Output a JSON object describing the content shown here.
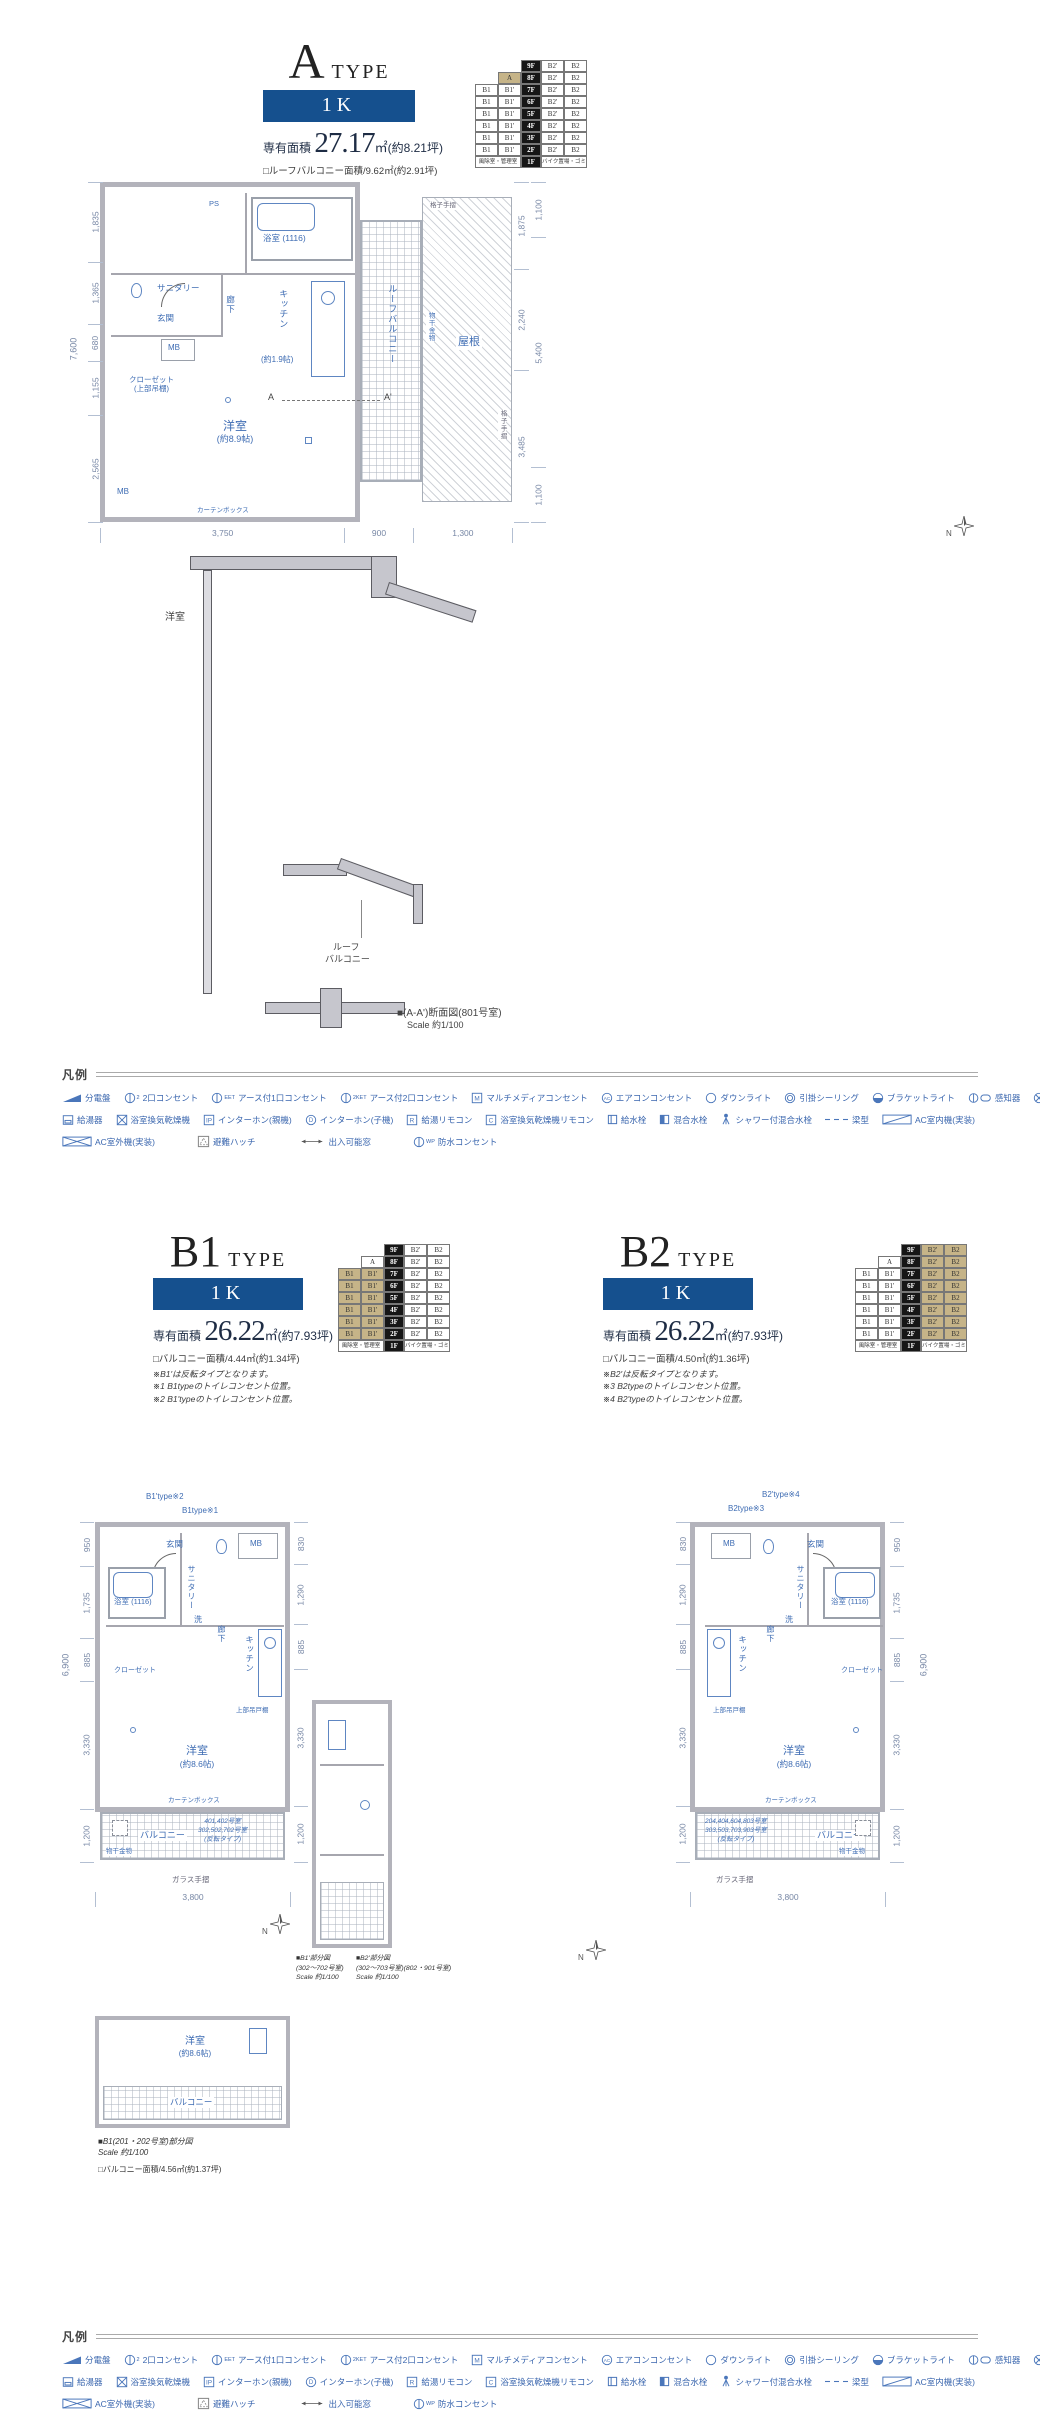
{
  "type_a": {
    "title": "A",
    "title_suffix": "TYPE",
    "plan_label": "1K",
    "area_label": "専有面積",
    "area_value": "27.17",
    "area_unit": "㎡",
    "area_tsubo": "(約8.21坪)",
    "balcony_note": "□ルーフバルコニー面積/9.62㎡(約2.91坪)",
    "dims": {
      "left_total": "7,600",
      "left": [
        "1,835",
        "1,365",
        "680",
        "1,155",
        "2,565"
      ],
      "right_inner": [
        "1,875",
        "2,240",
        "3,485"
      ],
      "right_outer": [
        "1,100",
        "5,400",
        "1,100"
      ],
      "bottom": [
        "3,750",
        "900",
        "1,300"
      ]
    },
    "rooms": {
      "bath": "浴室",
      "bath_size": "(1116)",
      "sanitary": "サニタリー",
      "ps": "PS",
      "entrance": "玄関",
      "hall": "廊下",
      "kitchen": "キッチン",
      "kitchen_size": "(約1.9帖)",
      "mb": "MB",
      "closet": "クローゼット",
      "closet_note": "(上部吊棚)",
      "western": "洋室",
      "western_size": "(約8.9帖)",
      "roof_balcony": "ルーフバルコニー",
      "roof": "屋根",
      "monohoshi": "物干金物",
      "koshi": "格子手摺",
      "curtain_box": "カーテンボックス",
      "marker_a": "A",
      "marker_a2": "A'"
    },
    "section": {
      "room": "洋室",
      "balcony_l1": "ルーフ",
      "balcony_l2": "バルコニー",
      "caption": "■(A-A')断面図(801号室)",
      "scale": "Scale 約1/100"
    }
  },
  "stack_a": {
    "rows": [
      {
        "skip": 2,
        "cells": [
          {
            "t": "9F",
            "s": "f"
          },
          {
            "t": "B2'",
            "s": "p"
          },
          {
            "t": "B2",
            "s": "p"
          }
        ]
      },
      {
        "skip": 1,
        "cells": [
          {
            "t": "A",
            "s": "h"
          },
          {
            "t": "8F",
            "s": "f"
          },
          {
            "t": "B2'",
            "s": "p"
          },
          {
            "t": "B2",
            "s": "p"
          }
        ]
      },
      {
        "skip": 0,
        "cells": [
          {
            "t": "B1",
            "s": "p"
          },
          {
            "t": "B1'",
            "s": "p"
          },
          {
            "t": "7F",
            "s": "f"
          },
          {
            "t": "B2'",
            "s": "p"
          },
          {
            "t": "B2",
            "s": "p"
          }
        ]
      },
      {
        "skip": 0,
        "cells": [
          {
            "t": "B1",
            "s": "p"
          },
          {
            "t": "B1'",
            "s": "p"
          },
          {
            "t": "6F",
            "s": "f"
          },
          {
            "t": "B2'",
            "s": "p"
          },
          {
            "t": "B2",
            "s": "p"
          }
        ]
      },
      {
        "skip": 0,
        "cells": [
          {
            "t": "B1",
            "s": "p"
          },
          {
            "t": "B1'",
            "s": "p"
          },
          {
            "t": "5F",
            "s": "f"
          },
          {
            "t": "B2'",
            "s": "p"
          },
          {
            "t": "B2",
            "s": "p"
          }
        ]
      },
      {
        "skip": 0,
        "cells": [
          {
            "t": "B1",
            "s": "p"
          },
          {
            "t": "B1'",
            "s": "p"
          },
          {
            "t": "4F",
            "s": "f"
          },
          {
            "t": "B2'",
            "s": "p"
          },
          {
            "t": "B2",
            "s": "p"
          }
        ]
      },
      {
        "skip": 0,
        "cells": [
          {
            "t": "B1",
            "s": "p"
          },
          {
            "t": "B1'",
            "s": "p"
          },
          {
            "t": "3F",
            "s": "f"
          },
          {
            "t": "B2'",
            "s": "p"
          },
          {
            "t": "B2",
            "s": "p"
          }
        ]
      },
      {
        "skip": 0,
        "cells": [
          {
            "t": "B1",
            "s": "p"
          },
          {
            "t": "B1'",
            "s": "p"
          },
          {
            "t": "2F",
            "s": "f"
          },
          {
            "t": "B2'",
            "s": "p"
          },
          {
            "t": "B2",
            "s": "p"
          }
        ]
      },
      {
        "skip": 0,
        "cells": [
          {
            "t": "風除室・管理室",
            "s": "w"
          },
          {
            "t": "1F",
            "s": "f"
          },
          {
            "t": "バイク置場・ゴミ置場",
            "s": "w"
          }
        ]
      }
    ]
  },
  "stack_b1": {
    "rows": [
      {
        "skip": 2,
        "cells": [
          {
            "t": "9F",
            "s": "f"
          },
          {
            "t": "B2'",
            "s": "p"
          },
          {
            "t": "B2",
            "s": "p"
          }
        ]
      },
      {
        "skip": 1,
        "cells": [
          {
            "t": "A",
            "s": "p"
          },
          {
            "t": "8F",
            "s": "f"
          },
          {
            "t": "B2'",
            "s": "p"
          },
          {
            "t": "B2",
            "s": "p"
          }
        ]
      },
      {
        "skip": 0,
        "cells": [
          {
            "t": "B1",
            "s": "h"
          },
          {
            "t": "B1'",
            "s": "h"
          },
          {
            "t": "7F",
            "s": "f"
          },
          {
            "t": "B2'",
            "s": "p"
          },
          {
            "t": "B2",
            "s": "p"
          }
        ]
      },
      {
        "skip": 0,
        "cells": [
          {
            "t": "B1",
            "s": "h"
          },
          {
            "t": "B1'",
            "s": "h"
          },
          {
            "t": "6F",
            "s": "f"
          },
          {
            "t": "B2'",
            "s": "p"
          },
          {
            "t": "B2",
            "s": "p"
          }
        ]
      },
      {
        "skip": 0,
        "cells": [
          {
            "t": "B1",
            "s": "h"
          },
          {
            "t": "B1'",
            "s": "h"
          },
          {
            "t": "5F",
            "s": "f"
          },
          {
            "t": "B2'",
            "s": "p"
          },
          {
            "t": "B2",
            "s": "p"
          }
        ]
      },
      {
        "skip": 0,
        "cells": [
          {
            "t": "B1",
            "s": "h"
          },
          {
            "t": "B1'",
            "s": "h"
          },
          {
            "t": "4F",
            "s": "f"
          },
          {
            "t": "B2'",
            "s": "p"
          },
          {
            "t": "B2",
            "s": "p"
          }
        ]
      },
      {
        "skip": 0,
        "cells": [
          {
            "t": "B1",
            "s": "h"
          },
          {
            "t": "B1'",
            "s": "h"
          },
          {
            "t": "3F",
            "s": "f"
          },
          {
            "t": "B2'",
            "s": "p"
          },
          {
            "t": "B2",
            "s": "p"
          }
        ]
      },
      {
        "skip": 0,
        "cells": [
          {
            "t": "B1",
            "s": "h"
          },
          {
            "t": "B1'",
            "s": "h"
          },
          {
            "t": "2F",
            "s": "f"
          },
          {
            "t": "B2'",
            "s": "p"
          },
          {
            "t": "B2",
            "s": "p"
          }
        ]
      },
      {
        "skip": 0,
        "cells": [
          {
            "t": "風除室・管理室",
            "s": "w"
          },
          {
            "t": "1F",
            "s": "f"
          },
          {
            "t": "バイク置場・ゴミ置場",
            "s": "w"
          }
        ]
      }
    ]
  },
  "stack_b2": {
    "rows": [
      {
        "skip": 2,
        "cells": [
          {
            "t": "9F",
            "s": "f"
          },
          {
            "t": "B2'",
            "s": "h"
          },
          {
            "t": "B2",
            "s": "h"
          }
        ]
      },
      {
        "skip": 1,
        "cells": [
          {
            "t": "A",
            "s": "p"
          },
          {
            "t": "8F",
            "s": "f"
          },
          {
            "t": "B2'",
            "s": "h"
          },
          {
            "t": "B2",
            "s": "h"
          }
        ]
      },
      {
        "skip": 0,
        "cells": [
          {
            "t": "B1",
            "s": "p"
          },
          {
            "t": "B1'",
            "s": "p"
          },
          {
            "t": "7F",
            "s": "f"
          },
          {
            "t": "B2'",
            "s": "h"
          },
          {
            "t": "B2",
            "s": "h"
          }
        ]
      },
      {
        "skip": 0,
        "cells": [
          {
            "t": "B1",
            "s": "p"
          },
          {
            "t": "B1'",
            "s": "p"
          },
          {
            "t": "6F",
            "s": "f"
          },
          {
            "t": "B2'",
            "s": "h"
          },
          {
            "t": "B2",
            "s": "h"
          }
        ]
      },
      {
        "skip": 0,
        "cells": [
          {
            "t": "B1",
            "s": "p"
          },
          {
            "t": "B1'",
            "s": "p"
          },
          {
            "t": "5F",
            "s": "f"
          },
          {
            "t": "B2'",
            "s": "h"
          },
          {
            "t": "B2",
            "s": "h"
          }
        ]
      },
      {
        "skip": 0,
        "cells": [
          {
            "t": "B1",
            "s": "p"
          },
          {
            "t": "B1'",
            "s": "p"
          },
          {
            "t": "4F",
            "s": "f"
          },
          {
            "t": "B2'",
            "s": "h"
          },
          {
            "t": "B2",
            "s": "h"
          }
        ]
      },
      {
        "skip": 0,
        "cells": [
          {
            "t": "B1",
            "s": "p"
          },
          {
            "t": "B1'",
            "s": "p"
          },
          {
            "t": "3F",
            "s": "f"
          },
          {
            "t": "B2'",
            "s": "h"
          },
          {
            "t": "B2",
            "s": "h"
          }
        ]
      },
      {
        "skip": 0,
        "cells": [
          {
            "t": "B1",
            "s": "p"
          },
          {
            "t": "B1'",
            "s": "p"
          },
          {
            "t": "2F",
            "s": "f"
          },
          {
            "t": "B2'",
            "s": "h"
          },
          {
            "t": "B2",
            "s": "h"
          }
        ]
      },
      {
        "skip": 0,
        "cells": [
          {
            "t": "風除室・管理室",
            "s": "w"
          },
          {
            "t": "1F",
            "s": "f"
          },
          {
            "t": "バイク置場・ゴミ置場",
            "s": "w"
          }
        ]
      }
    ]
  },
  "type_b1": {
    "title": "B1",
    "title_suffix": "TYPE",
    "plan_label": "1K",
    "area_label": "専有面積",
    "area_value": "26.22",
    "area_unit": "㎡",
    "area_tsubo": "(約7.93坪)",
    "balcony_note": "□バルコニー面積/4.44㎡(約1.34坪)",
    "notes": [
      "※B1'は反転タイプとなります。",
      "※1 B1typeのトイレコンセント位置。",
      "※2 B1'typeのトイレコンセント位置。"
    ],
    "anno_top1": "B1'type※2",
    "anno_top2": "B1type※1",
    "dims": {
      "total": "6,900",
      "left": [
        "950",
        "1,735",
        "885",
        "3,330",
        "1,200"
      ],
      "right": [
        "830",
        "1,290",
        "885",
        "3,330",
        "1,200"
      ],
      "bottom": [
        "3,800"
      ]
    },
    "rooms": {
      "entrance": "玄関",
      "mb": "MB",
      "sanitary": "サニタリー",
      "bath": "浴室",
      "bath_size": "(1116)",
      "wash": "洗",
      "hall": "廊下",
      "kitchen": "キッチン",
      "hanging": "上部吊戸棚",
      "closet": "クローゼット",
      "western": "洋室",
      "western_size": "(約8.6帖)",
      "curtain_box": "カーテンボックス",
      "balcony": "バルコニー",
      "monohoshi": "物干金物",
      "glass_rail": "ガラス手摺"
    },
    "unit_note": [
      "401,402号室",
      "302,502,702号室",
      "(反転タイプ)"
    ]
  },
  "type_b2": {
    "title": "B2",
    "title_suffix": "TYPE",
    "plan_label": "1K",
    "area_label": "専有面積",
    "area_value": "26.22",
    "area_unit": "㎡",
    "area_tsubo": "(約7.93坪)",
    "balcony_note": "□バルコニー面積/4.50㎡(約1.36坪)",
    "notes": [
      "※B2'は反転タイプとなります。",
      "※3 B2typeのトイレコンセント位置。",
      "※4 B2'typeのトイレコンセント位置。"
    ],
    "anno_top1": "B2'type※4",
    "anno_top2": "B2type※3",
    "dims": {
      "total": "6,900",
      "left": [
        "830",
        "1,290",
        "885",
        "3,330",
        "1,200"
      ],
      "right": [
        "950",
        "1,735",
        "885",
        "3,330",
        "1,200"
      ],
      "bottom": [
        "3,800"
      ]
    },
    "rooms": {
      "entrance": "玄関",
      "mb": "MB",
      "sanitary": "サニタリー",
      "bath": "浴室",
      "bath_size": "(1116)",
      "wash": "洗",
      "hall": "廊下",
      "kitchen": "キッチン",
      "hanging": "上部吊戸棚",
      "closet": "クローゼット",
      "western": "洋室",
      "western_size": "(約8.6帖)",
      "curtain_box": "カーテンボックス",
      "balcony": "バルコニー",
      "monohoshi": "物干金物",
      "glass_rail": "ガラス手摺"
    },
    "unit_note": [
      "204,404,604,803号室",
      "303,503,703,903号室",
      "(反転タイプ)"
    ]
  },
  "partials": {
    "mid_cap1": [
      "■B1'部分図",
      "(302〜702号室)",
      "Scale 約1/100"
    ],
    "mid_cap2": [
      "■B2'部分図",
      "(302〜703号室)(802・901号室)",
      "Scale 約1/100"
    ],
    "bottom_cap": [
      "■B1(201・202号室)部分図",
      "Scale 約1/100"
    ],
    "bottom_balcony_note": "□バルコニー面積/4.56㎡(約1.37坪)",
    "bottom_rooms": {
      "western": "洋室",
      "western_size": "(約8.6帖)",
      "balcony": "バルコニー"
    }
  },
  "legend": {
    "title": "凡例",
    "rows": [
      [
        {
          "name": "distribution-board",
          "icon": "board",
          "label": "分電盤"
        },
        {
          "name": "outlet-2",
          "icon": "outlet",
          "sup": "2",
          "label": "2口コンセント"
        },
        {
          "name": "outlet-1-earth",
          "icon": "outlet",
          "sup": "EET",
          "label": "アース付1口コンセント"
        },
        {
          "name": "outlet-2-earth",
          "icon": "outlet",
          "sup": "2KET",
          "label": "アース付2口コンセント"
        },
        {
          "name": "multimedia-outlet",
          "icon": "rletter",
          "letter": "M",
          "label": "マルチメディアコンセント"
        },
        {
          "name": "aircon-outlet",
          "icon": "cletter",
          "letter": "AC",
          "label": "エアコンコンセント"
        },
        {
          "name": "downlight",
          "icon": "down",
          "label": "ダウンライト"
        },
        {
          "name": "ceiling-rose",
          "icon": "ceiling",
          "label": "引掛シーリング"
        },
        {
          "name": "bracket-light",
          "icon": "bracket",
          "label": "ブラケットライト"
        },
        {
          "name": "sensor",
          "icon": "sensor",
          "label": "感知器"
        },
        {
          "name": "exhaust-fan",
          "icon": "fan",
          "label": "換気扇"
        },
        {
          "name": "vent",
          "icon": "xsq",
          "label": "換気口"
        }
      ],
      [
        {
          "name": "water-heater",
          "icon": "heater",
          "label": "給湯器"
        },
        {
          "name": "bath-dryer",
          "icon": "xsq",
          "label": "浴室換気乾燥機"
        },
        {
          "name": "intercom-main",
          "icon": "rletter",
          "letter": "IP",
          "label": "インターホン(親機)"
        },
        {
          "name": "intercom-sub",
          "icon": "cletter",
          "letter": "D",
          "label": "インターホン(子機)"
        },
        {
          "name": "hotwater-remote",
          "icon": "rletter",
          "letter": "R",
          "label": "給湯リモコン"
        },
        {
          "name": "bathdryer-remote",
          "icon": "rletter",
          "letter": "C",
          "label": "浴室換気乾燥機リモコン"
        },
        {
          "name": "water-tap",
          "icon": "tap",
          "label": "給水栓"
        },
        {
          "name": "mixer-tap",
          "icon": "mixer",
          "label": "混合水栓"
        },
        {
          "name": "shower-mixer-tap",
          "icon": "shower",
          "label": "シャワー付混合水栓"
        },
        {
          "name": "beam",
          "icon": "beam",
          "label": "梁型"
        },
        {
          "name": "ac-indoor-unit",
          "icon": "acin",
          "label": "AC室内機(実装)"
        }
      ],
      [
        {
          "name": "ac-outdoor-unit",
          "icon": "acout",
          "label": "AC室外機(実装)"
        },
        {
          "name": "escape-hatch",
          "icon": "hatch",
          "label": "避難ハッチ"
        },
        {
          "name": "accessible-window",
          "icon": "arrow",
          "label": "出入可能窓"
        },
        {
          "name": "waterproof-outlet",
          "icon": "outlet",
          "sup": "WP",
          "label": "防水コンセント"
        }
      ]
    ]
  },
  "compass": {
    "label": "N"
  }
}
